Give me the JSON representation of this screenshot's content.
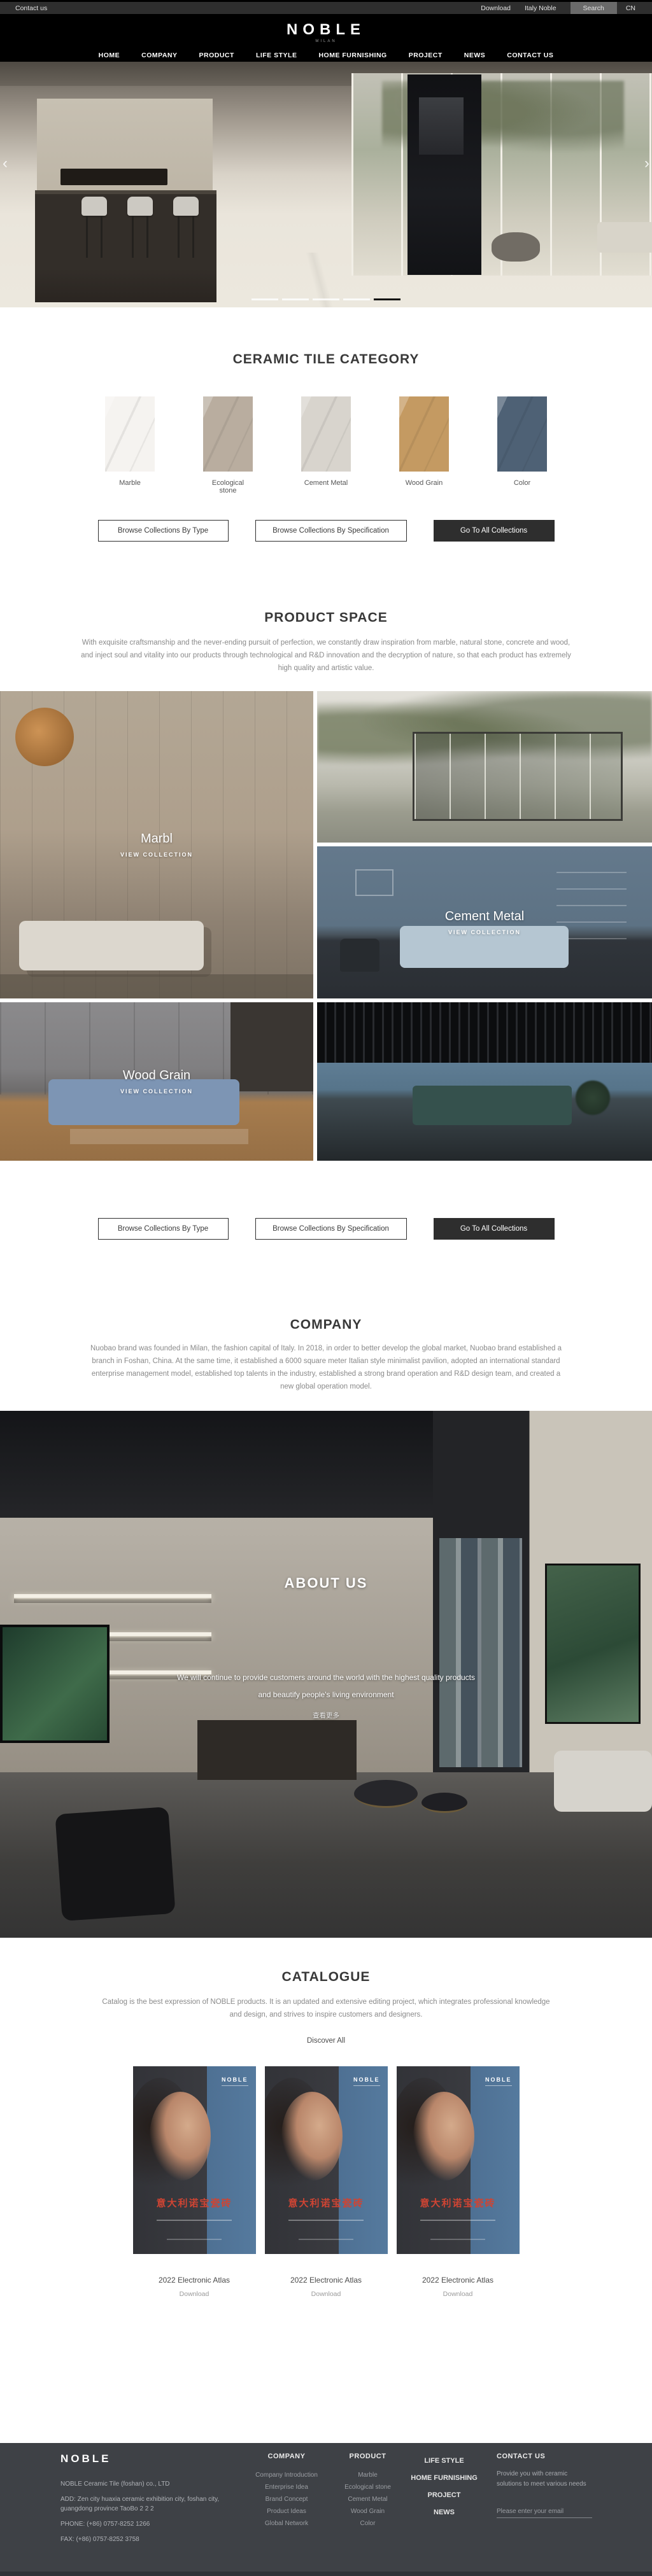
{
  "topbar": {
    "contact": "Contact us",
    "download": "Download",
    "italy_noble": "Italy Noble",
    "search": "Search",
    "lang": "CN"
  },
  "header": {
    "logo": "NOBLE",
    "logo_sub": "MILAN",
    "nav": [
      "HOME",
      "COMPANY",
      "PRODUCT",
      "LIFE STYLE",
      "HOME FURNISHING",
      "PROJECT",
      "NEWS",
      "CONTACT US"
    ]
  },
  "hero": {
    "prev": "‹",
    "next": "›",
    "slides_total": 5,
    "active_slide": 5
  },
  "category": {
    "title": "CERAMIC TILE CATEGORY",
    "items": [
      {
        "label": "Marble",
        "color": "#f5f3f0"
      },
      {
        "label": "Ecological stone",
        "color": "#b9ad9f"
      },
      {
        "label": "Cement Metal",
        "color": "#d8d4cd"
      },
      {
        "label": "Wood Grain",
        "color": "#c49a62"
      },
      {
        "label": "Color",
        "color": "#4e6175"
      }
    ]
  },
  "collection_buttons": {
    "by_type": "Browse Collections By Type",
    "by_spec": "Browse Collections By Specification",
    "go_all": "Go To All Collections"
  },
  "product_space": {
    "title": "PRODUCT SPACE",
    "description": "With exquisite craftsmanship and the never-ending pursuit of perfection, we constantly draw inspiration from marble, natural stone, concrete and wood, and inject soul and vitality into our products through technological and R&D innovation and the decryption of nature, so that each product has extremely high quality and artistic value.",
    "collections": [
      {
        "name": "Marbl",
        "cta": "VIEW COLLECTION"
      },
      {
        "name": "Cement Metal",
        "cta": "VIEW COLLECTION"
      },
      {
        "name": "Wood Grain",
        "cta": "VIEW COLLECTION"
      }
    ]
  },
  "company": {
    "title": "COMPANY",
    "description": "Nuobao brand was founded in Milan, the fashion capital of Italy. In 2018, in order to better develop the global market, Nuobao brand established a branch in Foshan, China. At the same time, it established a 6000 square meter Italian style minimalist pavilion, adopted an international standard enterprise management model, established top talents in the industry, established a strong brand operation and R&D design team, and created a new global operation model."
  },
  "about": {
    "title": "ABOUT US",
    "line1": "We will continue to provide customers around the world with the highest quality products",
    "line2": "and beautify people's living environment",
    "view_more": "查看更多"
  },
  "catalogue": {
    "title": "CATALOGUE",
    "description": "Catalog is the best expression of NOBLE products. It is an updated and extensive editing project, which integrates professional knowledge and design, and strives to inspire customers and designers.",
    "discover": "Discover All",
    "poster_brand": "NOBLE",
    "poster_headline": "意大利诺宝瓷砖",
    "posters": [
      {
        "name": "2022 Electronic Atlas",
        "download": "Download"
      },
      {
        "name": "2022 Electronic Atlas",
        "download": "Download"
      },
      {
        "name": "2022 Electronic Atlas",
        "download": "Download"
      }
    ],
    "accent_red": "#cf4433",
    "poster_blue": "#557a9e"
  },
  "footer": {
    "brand": "NOBLE",
    "company_name": "NOBLE Ceramic Tile (foshan) co., LTD",
    "address": "ADD:  Zen city huaxia ceramic exhibition city, foshan city, guangdong province TaoBo 2 2 2",
    "phone": "PHONE:   (+86)  0757-8252 1266",
    "fax": "FAX:   (+86)  0757-8252 3758",
    "company": {
      "title": "COMPANY",
      "items": [
        "Company Introduction",
        "Enterprise Idea",
        "Brand Concept",
        "Product Ideas",
        "Global Network"
      ]
    },
    "product": {
      "title": "PRODUCT",
      "items": [
        "Marble",
        "Ecological stone",
        "Cement Metal",
        "Wood Grain",
        "Color"
      ]
    },
    "explore": {
      "items": [
        "LIFE STYLE",
        "HOME FURNISHING",
        "PROJECT",
        "NEWS"
      ]
    },
    "contact": {
      "title": "CONTACT US",
      "blurb": "Provide you with ceramic solutions to meet various needs",
      "email_placeholder": "Please enter your email"
    },
    "bg_color": "#3e4146"
  }
}
